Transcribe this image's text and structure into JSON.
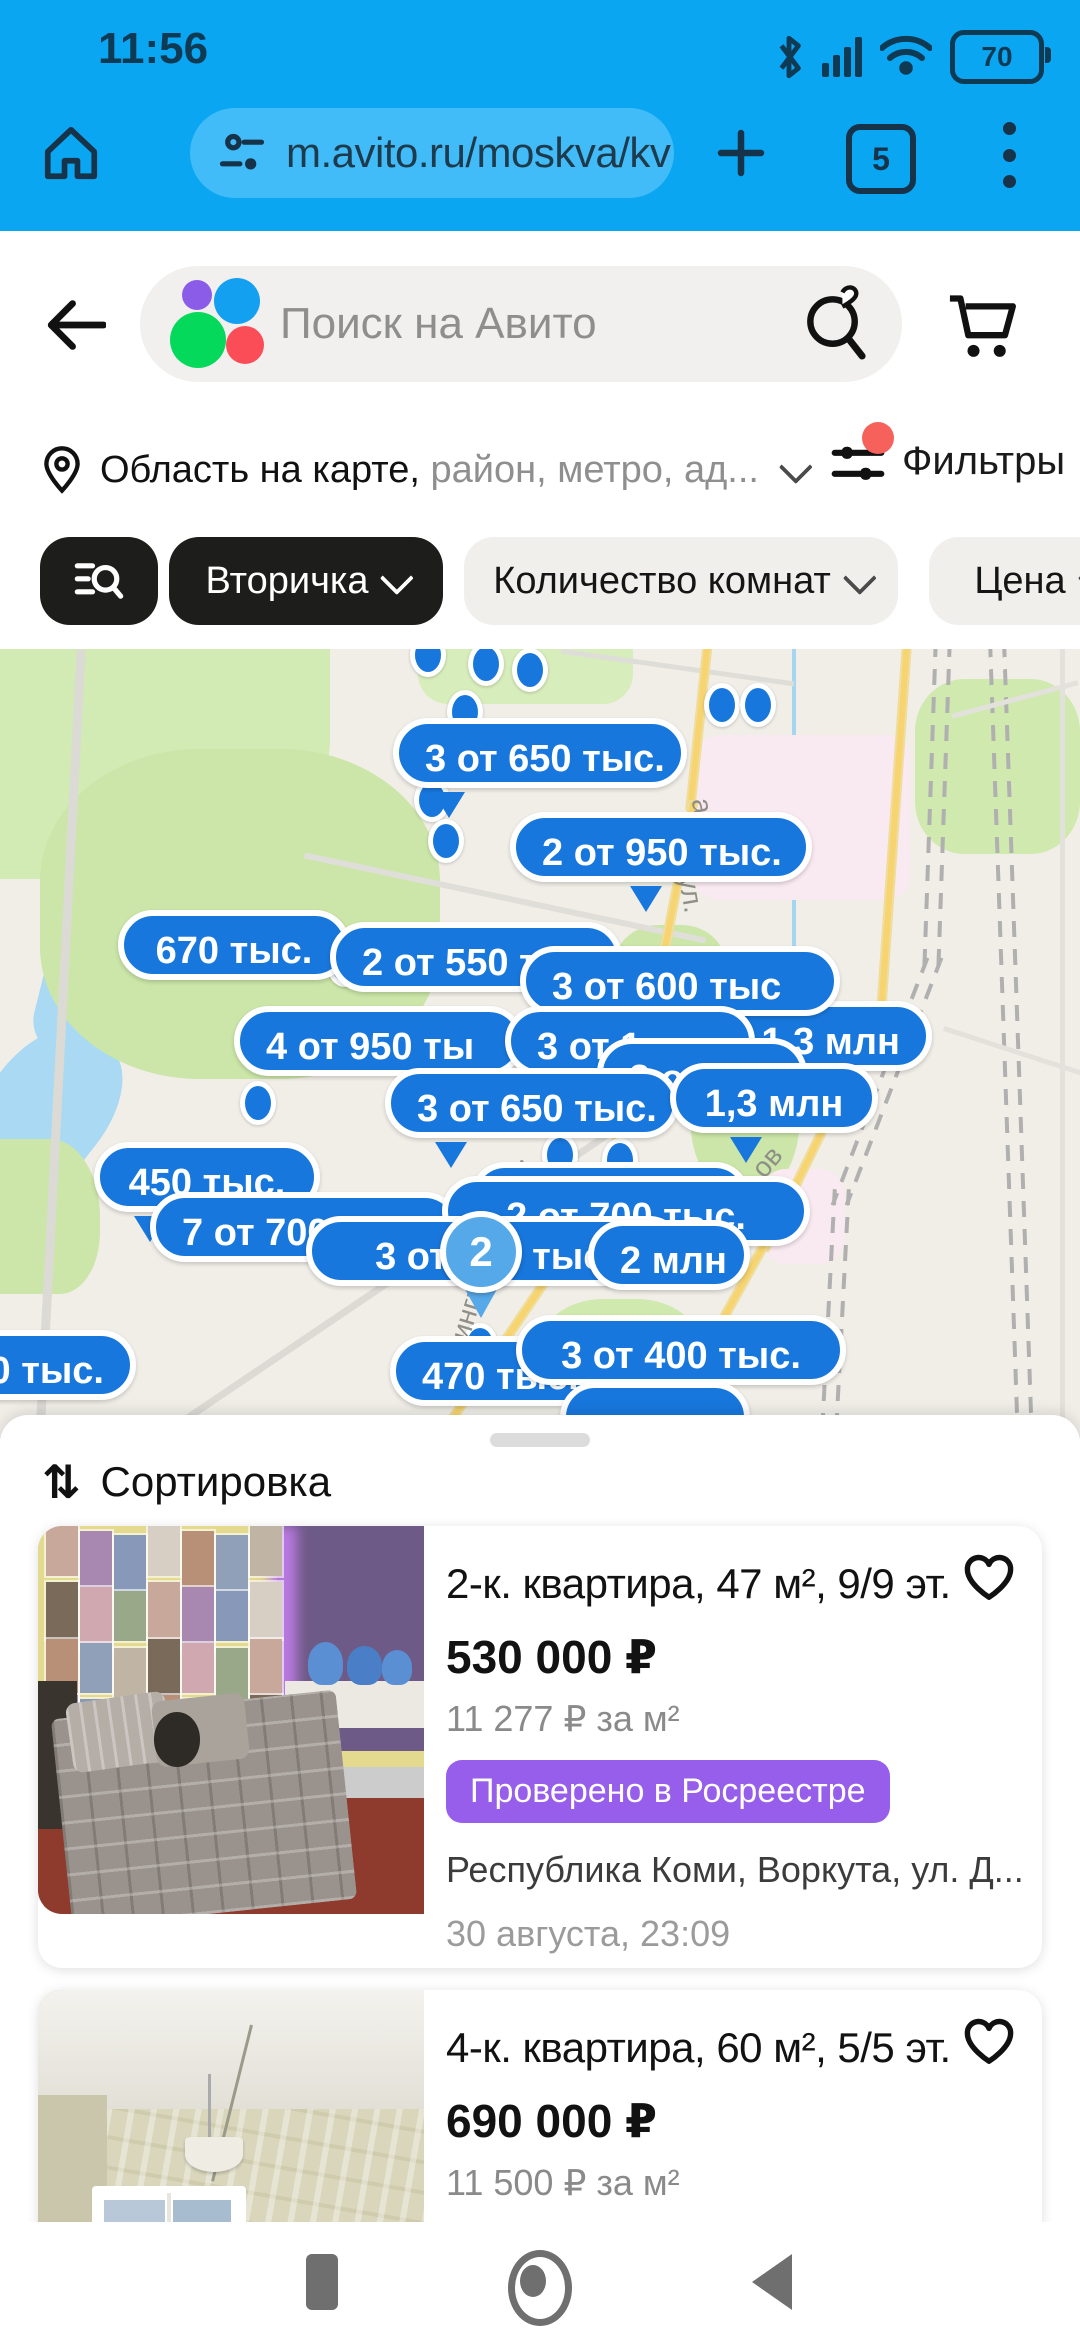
{
  "status_bar": {
    "time": "11:56",
    "battery_level": "70"
  },
  "browser": {
    "url": "m.avito.ru/moskva/kv",
    "tab_count": "5"
  },
  "search": {
    "placeholder": "Поиск на Авито"
  },
  "location_bar": {
    "primary": "Область на карте,",
    "secondary": " район, метро, ад...",
    "filters_label": "Фильтры"
  },
  "chips": {
    "saved_search": "",
    "category": "Вторичка",
    "rooms": "Количество комнат",
    "price": "Цена"
  },
  "map": {
    "bubbles": [
      {
        "t": "3 от 650 тыс.",
        "x": 393,
        "y": 718,
        "w": 294,
        "a": "c",
        "tail": 40
      },
      {
        "t": "2 от 950 тыс.",
        "x": 510,
        "y": 812,
        "w": 302,
        "a": "c",
        "tail": 120
      },
      {
        "t": "670 тыс.",
        "x": 118,
        "y": 910,
        "w": 232,
        "a": "c",
        "tail": null
      },
      {
        "t": "2 от 550 ты",
        "x": 330,
        "y": 922,
        "w": 292,
        "a": "l",
        "tail": null
      },
      {
        "t": "от 1,3 млн",
        "x": 580,
        "y": 1001,
        "w": 352,
        "a": "r",
        "tail": null
      },
      {
        "t": "3 от 600 тыс",
        "x": 520,
        "y": 946,
        "w": 320,
        "a": "l",
        "tail": null
      },
      {
        "t": "4 от 950 ты",
        "x": 234,
        "y": 1006,
        "w": 290,
        "a": "l",
        "tail": null
      },
      {
        "t": "3 от 1",
        "x": 505,
        "y": 1006,
        "w": 250,
        "a": "l",
        "tail": null
      },
      {
        "t": "3 от",
        "x": 597,
        "y": 1038,
        "w": 210,
        "a": "l",
        "tail": null
      },
      {
        "t": "3 от 650 тыс.",
        "x": 385,
        "y": 1068,
        "w": 294,
        "a": "c",
        "tail": 50
      },
      {
        "t": "1,3 млн",
        "x": 670,
        "y": 1063,
        "w": 208,
        "a": "c",
        "tail": 60
      },
      {
        "t": "450 тыс.",
        "x": 94,
        "y": 1142,
        "w": 226,
        "a": "c",
        "tail": 40
      },
      {
        "t": "2 от 1",
        "x": 470,
        "y": 1162,
        "w": 280,
        "a": "l",
        "tail": null
      },
      {
        "t": "7 от 700",
        "x": 150,
        "y": 1192,
        "w": 310,
        "a": "l",
        "tail": null
      },
      {
        "t": "2 от 700 тыс.",
        "x": 442,
        "y": 1176,
        "w": 368,
        "a": "c",
        "tail": null
      },
      {
        "t": "3 от 700 тыс.",
        "x": 306,
        "y": 1216,
        "w": 378,
        "a": "c",
        "tail": null
      },
      {
        "t": "2 млн",
        "x": 588,
        "y": 1220,
        "w": 162,
        "a": "c",
        "tail": null
      },
      {
        "t": "470 тыс.",
        "x": 390,
        "y": 1336,
        "w": 280,
        "a": "l",
        "tail": null
      },
      {
        "t": "3 от 400 тыс.",
        "x": 516,
        "y": 1315,
        "w": 330,
        "a": "c",
        "tail": null
      },
      {
        "t": "",
        "x": 560,
        "y": 1382,
        "w": 190,
        "a": "c",
        "tail": null
      },
      {
        "t": "0 тыс.",
        "x": -82,
        "y": 1330,
        "w": 218,
        "a": "r",
        "tail": null
      }
    ],
    "dots": [
      [
        428,
        655
      ],
      [
        486,
        664
      ],
      [
        530,
        670
      ],
      [
        465,
        712
      ],
      [
        722,
        705
      ],
      [
        758,
        705
      ],
      [
        432,
        800
      ],
      [
        446,
        841
      ],
      [
        345,
        965
      ],
      [
        258,
        1103
      ],
      [
        368,
        1035
      ],
      [
        560,
        1155
      ],
      [
        620,
        1160
      ],
      [
        700,
        1340
      ],
      [
        480,
        1345
      ],
      [
        660,
        1350
      ]
    ],
    "pin": {
      "label": "2",
      "x": 481,
      "y": 1252
    },
    "street_labels": [
      {
        "t": "а",
        "x": 694,
        "y": 790,
        "r": 80
      },
      {
        "t": "ул.",
        "x": 672,
        "y": 878,
        "r": 80
      },
      {
        "t": "ов",
        "x": 752,
        "y": 1146,
        "r": -50
      },
      {
        "t": "Ленинградская ул.",
        "x": 360,
        "y": 1255,
        "r": -73
      }
    ]
  },
  "sheet": {
    "sort_label": "Сортировка"
  },
  "listings": [
    {
      "title": "2-к. квартира, 47 м², 9/9 эт.",
      "price": "530 000 ₽",
      "price_per": "11 277 ₽ за м²",
      "badge": "Проверено в Росреестре",
      "address": "Республика Коми, Воркута, ул. Д...",
      "date": "30 августа, 23:09"
    },
    {
      "title": "4-к. квартира, 60 м², 5/5 эт.",
      "price": "690 000 ₽",
      "price_per": "11 500 ₽ за м²",
      "badge": "",
      "address": "",
      "date": ""
    }
  ],
  "colors": {
    "statusbar_blue": "#0ba6f2",
    "url_pill_blue": "#41bcf8",
    "bubble_blue": "#1877dd",
    "pin_blue": "#55a9e8",
    "badge_purple": "#965eeb",
    "alert_red": "#f6615c"
  }
}
